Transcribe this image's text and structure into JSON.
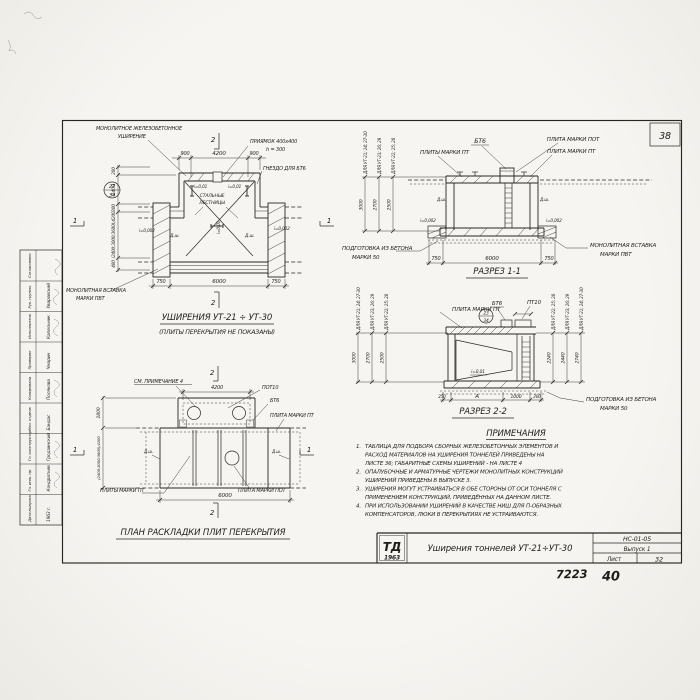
{
  "sheet": {
    "page_number": "38",
    "doc_code": "НС-01-05",
    "issue": "Выпуск 1",
    "sheet_label": "Лист",
    "sheet_number": "32",
    "logo_name": "ТД",
    "logo_year": "1963",
    "title": "Уширения тоннелей УТ-21÷УТ-30",
    "handwritten_left": "7223",
    "handwritten_right": "40"
  },
  "fig_plan": {
    "title": "УШИРЕНИЯ УТ-21 ÷ УТ-30",
    "subtitle": "(ПЛИТЫ ПЕРЕКРЫТИЯ НЕ ПОКАЗАНЫ)",
    "labels": {
      "widening_1": "МОНОЛИТНОЕ ЖЕЛЕЗОБЕТОННОЕ",
      "widening_2": "УШИРЕНИЕ",
      "pit_1": "ПРИЯМОК 400х400",
      "pit_2": "h = 300",
      "socket": "ГНЕЗДО ДЛЯ БТ6",
      "stairs_1": "СТАЛЬНЫЕ",
      "stairs_2": "ЛЕСТНИЦЫ",
      "insert_1": "МОНОЛИТНАЯ ВСТАВКА",
      "insert_2": "МАРКИ ПВТ",
      "joint": "Д.ш.",
      "slope_floor": "i=0,002",
      "slope_roof": "i=0,01",
      "detail_num": "27",
      "detail_sheet": "34"
    },
    "dims": {
      "top_left": "900",
      "top_mid": "4200",
      "top_right": "900",
      "bot_left": "750",
      "bot_mid": "6000",
      "bot_right": "750",
      "left_1": "200",
      "left_2": "1400",
      "left_3": "300",
      "left_4": "(2400;3000;3600);4200",
      "left_5": "400"
    },
    "marks": {
      "s1": "1",
      "s2": "2"
    }
  },
  "fig_sec1": {
    "title": "РАЗРЕЗ 1-1",
    "labels": {
      "bt6": "БТ6",
      "plate_pot": "ПЛИТА МАРКИ ПОТ",
      "plates_pt": "ПЛИТЫ МАРКИ ПТ",
      "plate_pt": "ПЛИТА МАРКИ ПТ",
      "prep_1": "ПОДГОТОВКА ИЗ БЕТОНА",
      "prep_2": "МАРКИ 50",
      "insert_1": "МОНОЛИТНАЯ ВСТАВКА",
      "insert_2": "МАРКИ ПВТ",
      "joint": "Д.ш.",
      "slope": "i=0,002"
    },
    "dims": {
      "bot_left": "750",
      "bot_mid": "6000",
      "bot_right": "750"
    },
    "heights": [
      {
        "value": "3000",
        "group": "ДЛЯ УТ-21; 24; 27-30"
      },
      {
        "value": "2700",
        "group": "ДЛЯ УТ-23; 26; 29"
      },
      {
        "value": "2500",
        "group": "ДЛЯ УТ-22; 25; 28"
      }
    ]
  },
  "fig_sec2": {
    "title": "РАЗРЕЗ 2-2",
    "labels": {
      "plate_pt": "ПЛИТА МАРКИ ПТ",
      "bt6": "БТ6",
      "pt10": "ПТ10",
      "slope": "i=0,01",
      "prep_1": "ПОДГОТОВКА ИЗ БЕТОНА",
      "prep_2": "МАРКИ 50",
      "detail_num": "23",
      "detail_sheet": "34"
    },
    "dims": {
      "bot_1": "250",
      "bot_2": "А",
      "bot_3": "1000",
      "bot_4": "200"
    },
    "left_heights": [
      {
        "value": "3000",
        "group": "ДЛЯ УТ-21; 24; 27-30"
      },
      {
        "value": "2700",
        "group": "ДЛЯ УТ-23; 26; 29"
      },
      {
        "value": "2500",
        "group": "ДЛЯ УТ-22; 25; 28"
      }
    ],
    "right_heights": [
      {
        "value": "2240",
        "group": "ДЛЯ УТ-22; 25; 28"
      },
      {
        "value": "2440",
        "group": "ДЛЯ УТ-23; 26; 29"
      },
      {
        "value": "2740",
        "group": "ДЛЯ УТ-21; 24; 27-30"
      }
    ]
  },
  "fig_layout": {
    "title": "ПЛАН РАСКЛАДКИ ПЛИТ ПЕРЕКРЫТИЯ",
    "labels": {
      "see_note": "СМ. ПРИМЕЧАНИЕ 4",
      "pot10": "ПОТ10",
      "bt6": "БТ6",
      "plate_pt": "ПЛИТА МАРКИ ПТ",
      "plates_pt": "ПЛИТЫ МАРКИ ПТ",
      "plate_pot": "ПЛИТА МАРКИ ПОТ",
      "joint": "Д.ш."
    },
    "dims": {
      "top": "4200",
      "bottom": "6000",
      "left_top": "1800",
      "left_main": "(2400;3000;3600);4200"
    },
    "marks": {
      "s1": "1",
      "s2": "2"
    }
  },
  "notes": {
    "heading": "ПРИМЕЧАНИЯ",
    "items": [
      {
        "num": "1.",
        "lines": [
          "ТАБЛИЦА ДЛЯ ПОДБОРА СБОРНЫХ ЖЕЛЕЗОБЕТОННЫХ ЭЛЕМЕНТОВ И",
          "РАСХОД МАТЕРИАЛОВ НА УШИРЕНИЯ ТОННЕЛЕЙ ПРИВЕДЕНЫ НА",
          "ЛИСТЕ 36; ГАБАРИТНЫЕ СХЕМЫ УШИРЕНИЙ - НА ЛИСТЕ 4"
        ]
      },
      {
        "num": "2.",
        "lines": [
          "ОПАЛУБОЧНЫЕ И АРМАТУРНЫЕ ЧЕРТЕЖИ МОНОЛИТНЫХ КОНСТРУКЦИЙ",
          "УШИРЕНИЙ ПРИВЕДЕНЫ В ВЫПУСКЕ 3."
        ]
      },
      {
        "num": "3.",
        "lines": [
          "УШИРЕНИЯ МОГУТ УСТРАИВАТЬСЯ В ОБЕ СТОРОНЫ ОТ ОСИ ТОННЕЛЯ С",
          "ПРИМЕНЕНИЕМ КОНСТРУКЦИЙ, ПРИВЕДЁННЫХ НА ДАННОМ ЛИСТЕ."
        ]
      },
      {
        "num": "4.",
        "lines": [
          "ПРИ ИСПОЛЬЗОВАНИИ УШИРЕНИЙ В КАЧЕСТВЕ НИШ ДЛЯ П-ОБРАЗНЫХ",
          "КОМПЕНСАТОРОВ, ЛЮКИ В ПЕРЕКРЫТИЯХ НЕ УСТРАИВАЮТСЯ."
        ]
      }
    ]
  },
  "staff": {
    "rows": [
      {
        "role": "Согласовано",
        "name": ""
      },
      {
        "role": "Рук. группы",
        "name": "Уваровский"
      },
      {
        "role": "Исполнитель",
        "name": "Капельник"
      },
      {
        "role": "Проверил",
        "name": "Чмарин"
      },
      {
        "role": "Копировала",
        "name": "Полякова"
      },
      {
        "role": "Нач. отдела",
        "name": "Бандас"
      },
      {
        "role": "Гл. конструктор",
        "name": "Гродзинский"
      },
      {
        "role": "Гл. инж. пр.",
        "name": "Кондратьев"
      },
      {
        "role": "Дата выпуска",
        "name": "1963 г."
      }
    ]
  }
}
